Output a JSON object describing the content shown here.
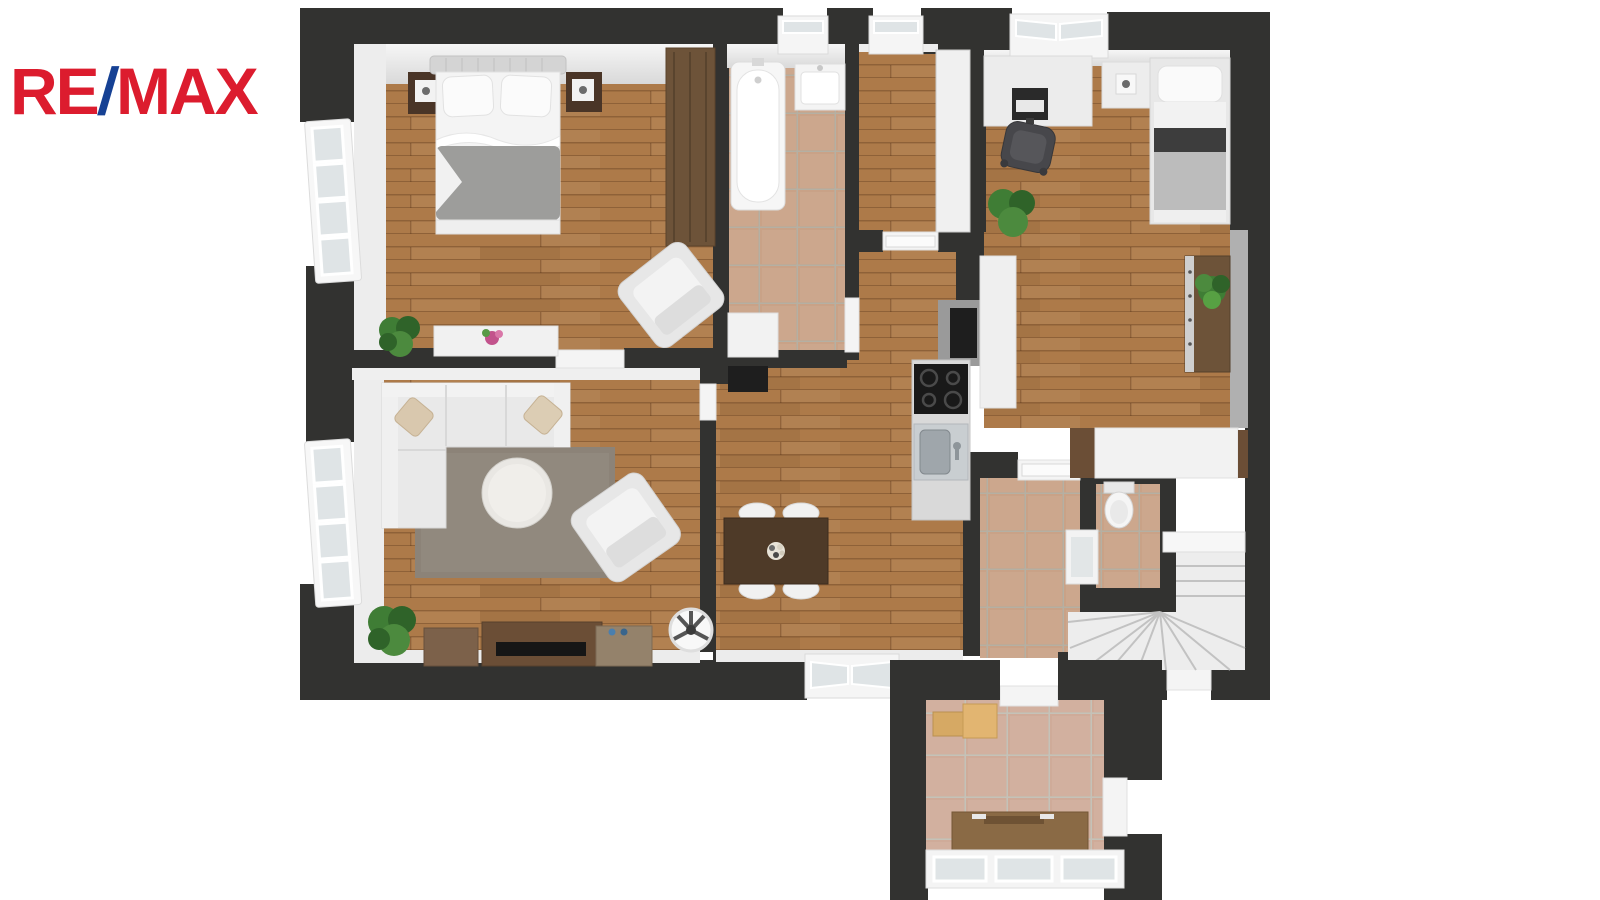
{
  "page": {
    "background": "#ffffff",
    "description": "3D top-down floor plan render of an apartment, RE/MAX branding top-left"
  },
  "logo": {
    "re": "RE",
    "slash": "/",
    "max": "MAX"
  },
  "palette": {
    "logo_red": "#DC1C2E",
    "logo_blue": "#164194",
    "wall": "#323230",
    "wall_face": "#f1f1f1",
    "wood": "#ad7a49",
    "tile": "#c9a287",
    "tile_grout": "#b5b0a3",
    "vtile": "#cfab99",
    "vtile_grout": "#c5c2b8",
    "rug": "#8c8378",
    "white_furniture": "#ededed",
    "dark_nightstand": "#4a3527",
    "wardrobe_wood": "#6d5339",
    "table_wood": "#4e3a28",
    "tv_wood": "#6b4e36",
    "blanket_gray": "#9d9d9b",
    "kid_blanket": "#bcbcbc",
    "counter_gray": "#d9d9d9",
    "cooktop_black": "#191919",
    "steel": "#c9ced1",
    "plant_green": "#3f7d35",
    "plant_dark": "#2f6329",
    "stairs_white": "#ededed",
    "stair_edge": "#c2c2c2",
    "glass": "#dfe4e6",
    "accent_black": "#1e1e1e"
  },
  "floorplan": {
    "type": "apartment-3d-top-view",
    "rooms": [
      {
        "id": "bedroom",
        "floor": "wood",
        "furniture": [
          "double-bed",
          "nightstand-left",
          "nightstand-right",
          "bedside-lamps",
          "wardrobe",
          "armchair",
          "sideboard-with-flowers",
          "potted-plant"
        ],
        "windows": [
          "left-wall-casement"
        ]
      },
      {
        "id": "living-room",
        "floor": "wood",
        "furniture": [
          "corner-sofa",
          "throw-pillows",
          "area-rug",
          "round-coffee-table",
          "armchair",
          "tv-lowboard",
          "tv",
          "side-cabinet-left",
          "side-cabinet-right",
          "potted-plant",
          "ceiling-fan"
        ],
        "windows": [
          "left-wall-casement"
        ]
      },
      {
        "id": "bathroom",
        "floor": "tile",
        "furniture": [
          "bathtub",
          "washbasin",
          "cabinet"
        ],
        "windows": [
          "top-wall"
        ]
      },
      {
        "id": "upper-hallway",
        "floor": "wood",
        "furniture": [
          "built-in-closet",
          "open-door"
        ],
        "windows": [
          "top-wall"
        ]
      },
      {
        "id": "kitchen-dining",
        "floor": "wood",
        "furniture": [
          "dining-table",
          "chair-1",
          "chair-2",
          "chair-3",
          "chair-4",
          "flower-centerpiece",
          "kitchen-counter",
          "cooktop",
          "sink",
          "vent-shaft",
          "dark-doormat"
        ],
        "windows": [
          "bottom-wall"
        ]
      },
      {
        "id": "kids-room",
        "floor": "wood",
        "furniture": [
          "desk",
          "monitor",
          "office-chair",
          "nightstand-with-lamp",
          "single-bed",
          "tall-cabinet",
          "shelf-sideboard",
          "potted-plant",
          "palm-plant"
        ],
        "windows": [
          "top-wall"
        ]
      },
      {
        "id": "lower-hallway",
        "floor": "tile",
        "furniture": [
          "built-in-wardrobe"
        ]
      },
      {
        "id": "wc",
        "floor": "tile",
        "furniture": [
          "toilet",
          "small-washbasin"
        ]
      },
      {
        "id": "staircase",
        "floor": "white-steps",
        "furniture": [
          "winder-stairs",
          "landing"
        ]
      },
      {
        "id": "vestibule",
        "floor": "tile",
        "furniture": [
          "storage-bench",
          "wall-shelf",
          "glazed-entrance-door",
          "side-door"
        ]
      }
    ]
  }
}
